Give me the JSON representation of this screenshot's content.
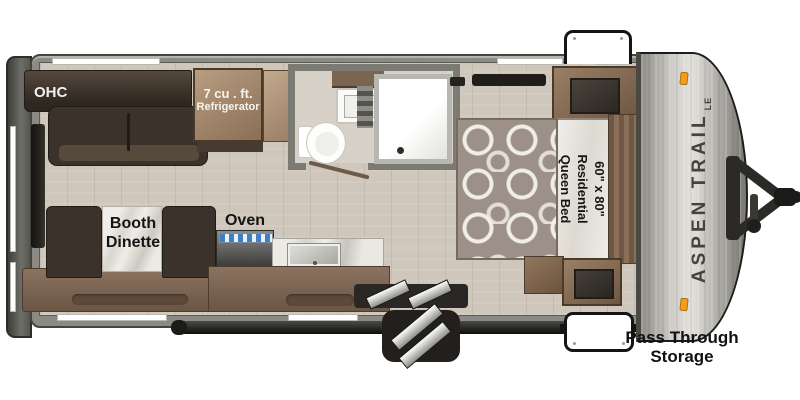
{
  "labels": {
    "ohc": "OHC",
    "fridge1": "7 cu . ft.",
    "fridge2": "Refrigerator",
    "dinette1": "Booth",
    "dinette2": "Dinette",
    "oven": "Oven",
    "bed1": "60\" x 80\"",
    "bed2": "Residential",
    "bed3": "Queen Bed",
    "brand": "ASPEN TRAIL",
    "brand_badge": "LE",
    "storage1": "Pass Through",
    "storage2": "Storage"
  },
  "colors": {
    "wall": "#8b8a84",
    "floor": "#cfc7bb",
    "dark_wood": "#3a322b",
    "cabinet_wood": "#8a7058",
    "marble": "#eceae5",
    "bed_fabric": "#9c9088",
    "marker_light": "#f39c1d",
    "burner_blue": "#3f7fc1",
    "cap_silver": "#cfcdc8",
    "label_text": "#141414"
  }
}
